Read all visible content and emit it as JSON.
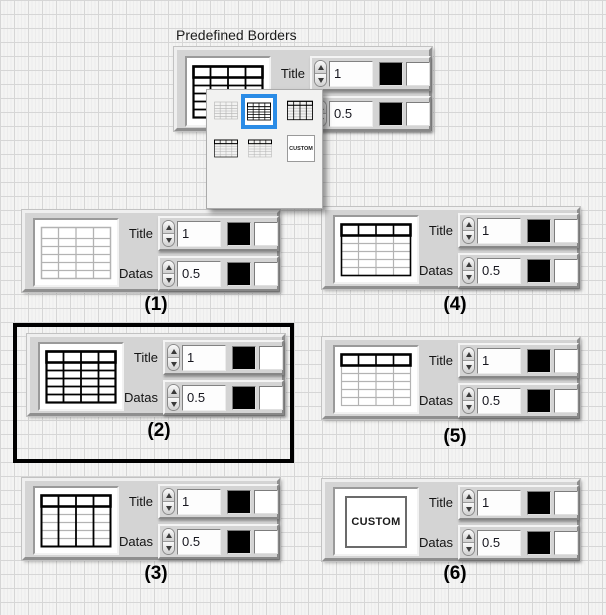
{
  "window": {
    "label": "Predefined Borders"
  },
  "colors": {
    "selection_highlight": "#2b8ce6",
    "selection_frame": "#000000"
  },
  "swatches": {
    "fg": "#000000",
    "bg": "#ffffff"
  },
  "top_panel": {
    "icon": "table-all-black",
    "title_label": "Title",
    "title_value": "1",
    "datas_label": "Datas",
    "datas_value": "0.5"
  },
  "dropdown": {
    "options": [
      {
        "name": "table-all-gray",
        "selected": false
      },
      {
        "name": "table-all-black",
        "selected": true
      },
      {
        "name": "table-black-header-and-columns",
        "selected": false
      },
      {
        "name": "table-black-header-and-body-outline",
        "selected": false
      },
      {
        "name": "table-black-header-only",
        "selected": false
      },
      {
        "name": "custom",
        "label": "CUSTOM",
        "selected": false
      }
    ]
  },
  "panels": [
    {
      "caption": "(1)",
      "icon": "table-all-gray",
      "selected": false,
      "title_label": "Title",
      "title_value": "1",
      "datas_label": "Datas",
      "datas_value": "0.5"
    },
    {
      "caption": "(2)",
      "icon": "table-all-black",
      "selected": true,
      "title_label": "Title",
      "title_value": "1",
      "datas_label": "Datas",
      "datas_value": "0.5"
    },
    {
      "caption": "(3)",
      "icon": "table-black-header-and-columns",
      "selected": false,
      "title_label": "Title",
      "title_value": "1",
      "datas_label": "Datas",
      "datas_value": "0.5"
    },
    {
      "caption": "(4)",
      "icon": "table-black-header-and-body-outline",
      "selected": false,
      "title_label": "Title",
      "title_value": "1",
      "datas_label": "Datas",
      "datas_value": "0.5"
    },
    {
      "caption": "(5)",
      "icon": "table-black-header-only",
      "selected": false,
      "title_label": "Title",
      "title_value": "1",
      "datas_label": "Datas",
      "datas_value": "0.5"
    },
    {
      "caption": "(6)",
      "icon": "custom",
      "custom_label": "CUSTOM",
      "selected": false,
      "title_label": "Title",
      "title_value": "1",
      "datas_label": "Datas",
      "datas_value": "0.5"
    }
  ]
}
